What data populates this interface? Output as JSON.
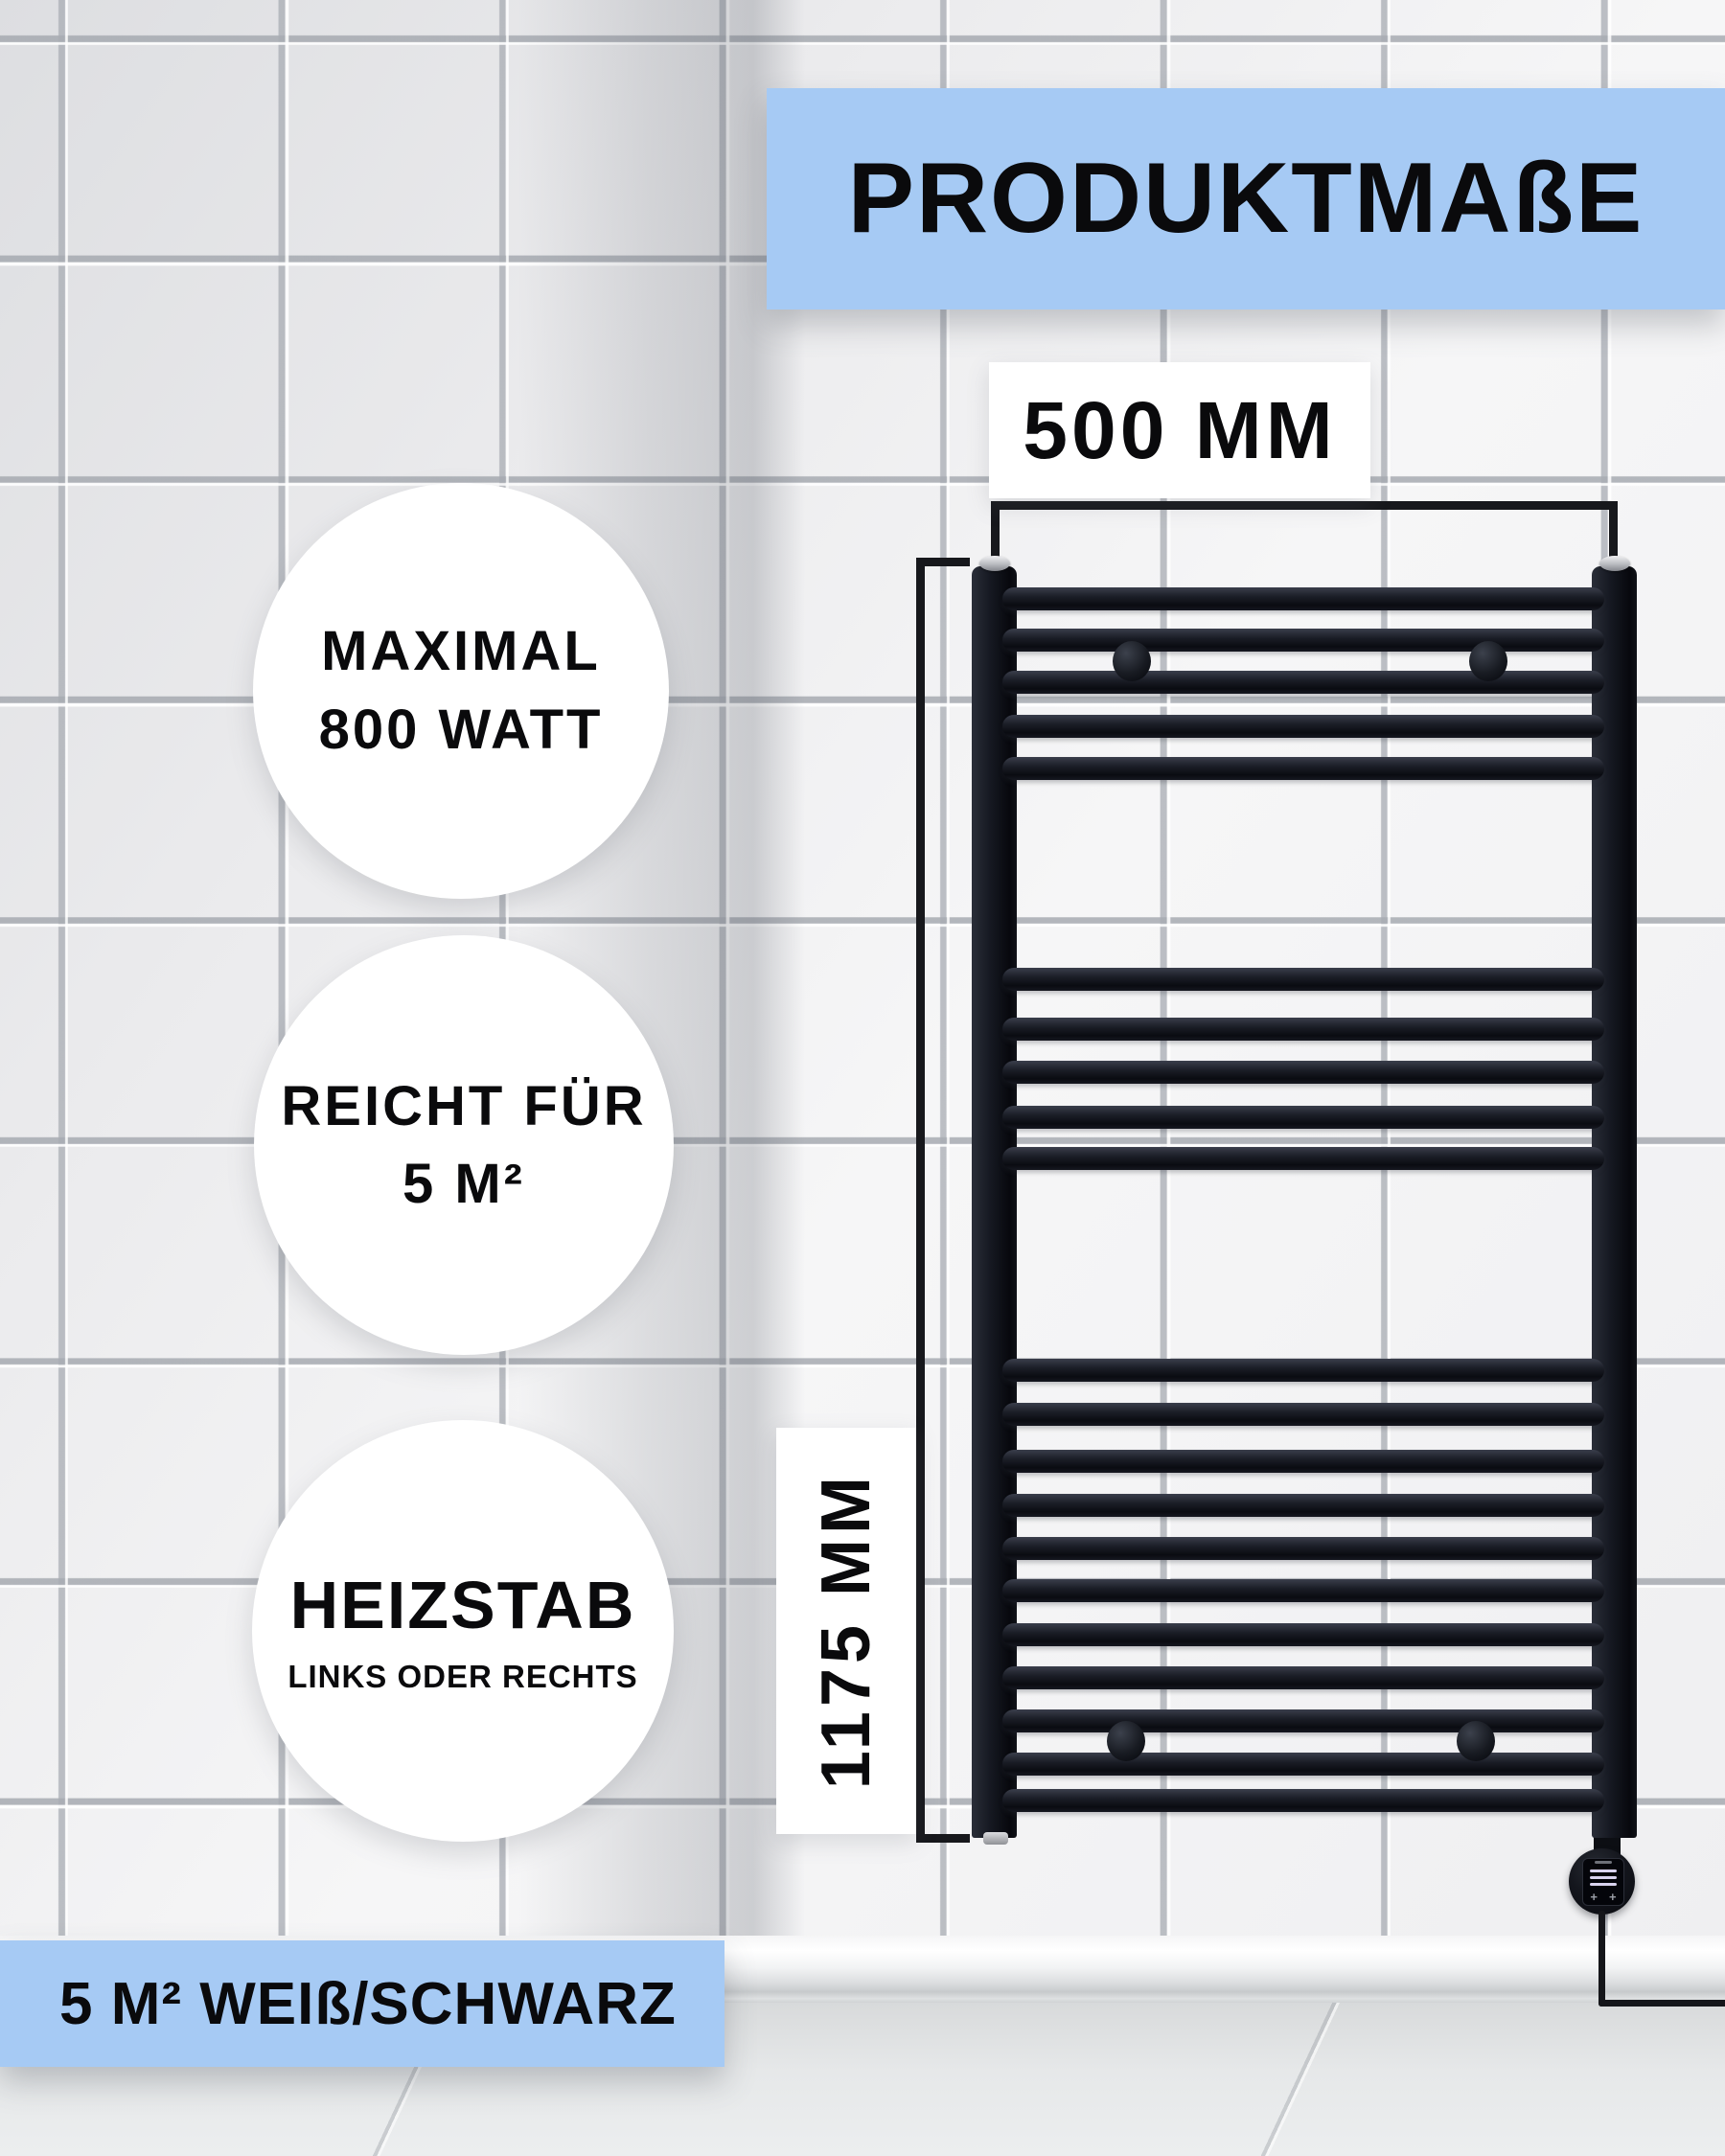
{
  "page": {
    "title_banner": "PRODUKTMAßE",
    "footer_banner": "5 M² WEIß/SCHWARZ"
  },
  "measurements": {
    "width": "500 MM",
    "height": "1175 MM"
  },
  "feature_badges": [
    {
      "line1": "MAXIMAL",
      "line2": "800 WATT"
    },
    {
      "line1": "REICHT FÜR",
      "line2": "5 M²"
    },
    {
      "line1": "HEIZSTAB",
      "line2": "LINKS ODER RECHTS"
    }
  ],
  "heater_controls": {
    "button_left": "+",
    "button_right": "+"
  },
  "colors": {
    "banner_blue": "#a6caf4",
    "radiator_black": "#12141c",
    "measure_line": "#17181c",
    "label_background": "#ffffff",
    "text": "#0a0a0c"
  },
  "radiator": {
    "rails_y": [
      625,
      668,
      712,
      758,
      802,
      1022,
      1074,
      1119,
      1166,
      1209,
      1430,
      1476,
      1525,
      1571,
      1616,
      1660,
      1706,
      1751,
      1796,
      1841,
      1879
    ],
    "wall_bracket_centers": [
      [
        1181,
        690
      ],
      [
        1553,
        690
      ],
      [
        1175,
        1817
      ],
      [
        1540,
        1817
      ]
    ]
  }
}
